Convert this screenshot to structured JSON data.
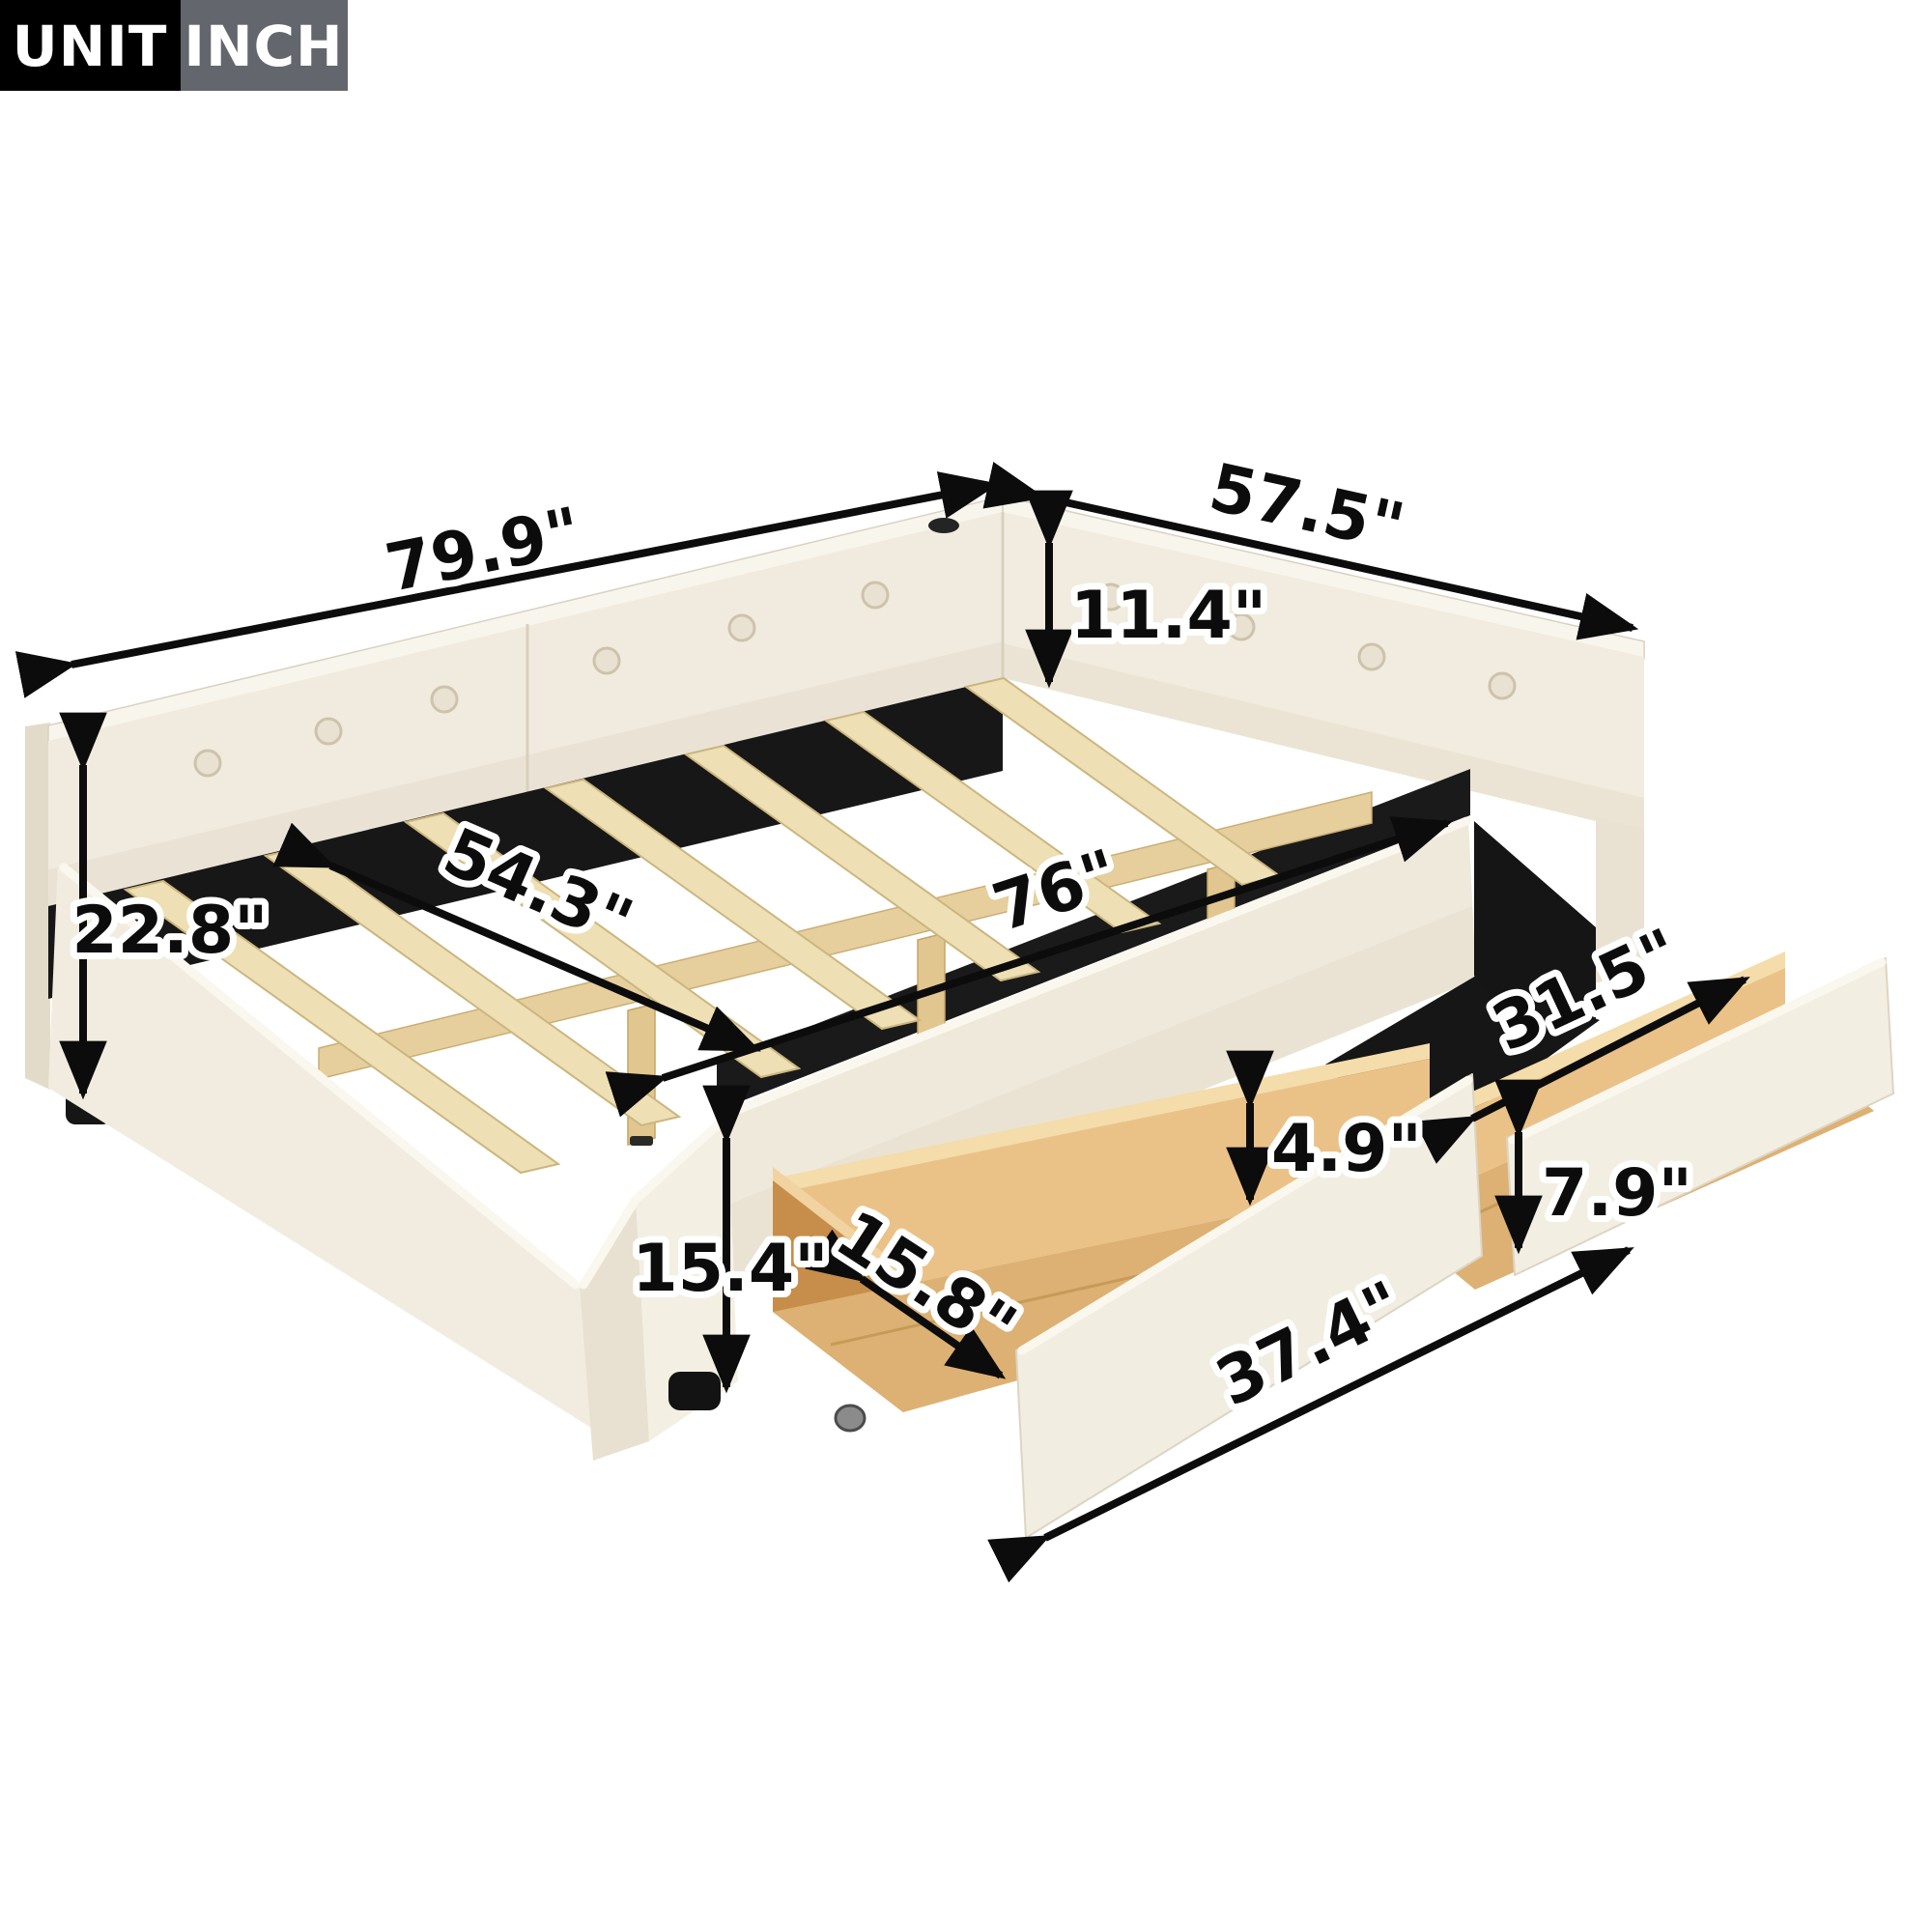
{
  "badge": {
    "label": "UNIT",
    "value": "INCH"
  },
  "measurements": {
    "overall_length": "79.9\"",
    "overall_width": "57.5\"",
    "backrest_height": "11.4\"",
    "back_total_height": "22.8\"",
    "inner_width": "54.3\"",
    "inner_length": "76\"",
    "drawer_inner_length": "31.5\"",
    "drawer_inner_height": "4.9\"",
    "drawer_front_height": "7.9\"",
    "drawer_inner_width": "15.8\"",
    "drawer_front_length": "37.4\"",
    "side_height": "15.4\""
  },
  "colors": {
    "fabric": "#f1ebdf",
    "fabric_shadow": "#e4dccb",
    "piping": "#faf7ee",
    "slat_wood": "#eedfb4",
    "drawer_wood": "#ddb173",
    "drawer_wood_inner": "#eac287",
    "drawer_wood_dark": "#c68e4a",
    "interior_black": "#171717",
    "dimension": "#0c0c0c",
    "badge_black": "#000000",
    "badge_gray": "#63666c"
  }
}
